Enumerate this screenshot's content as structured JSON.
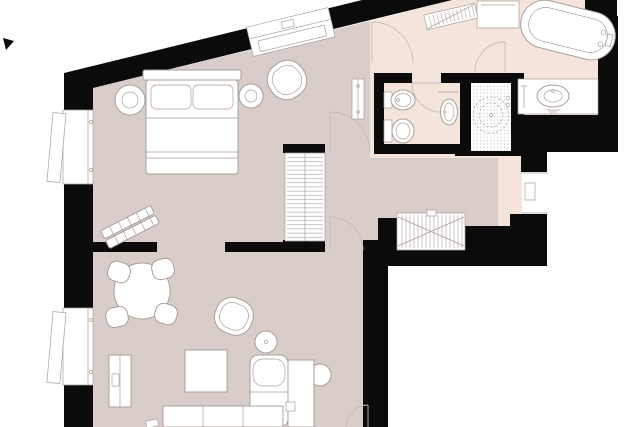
{
  "page": {
    "type": "architectural-floor-plan",
    "description": "Top-down 2D apartment floor plan, black walls, white line-drawn furniture, no text labels visible"
  },
  "colors": {
    "wall": "#0b0b0b",
    "floor_main": "#d9cdc9",
    "floor_bath": "#f5e4db",
    "furniture_fill": "#ffffff",
    "line": "#a9a09b",
    "detail_line": "#c6bcb6",
    "dots": "#b9b1ab",
    "background": "#ffffff"
  },
  "plan": {
    "rooms": [
      {
        "name": "bedroom",
        "floor": "floor_main",
        "contents": [
          "double bed with headboard and two pillows",
          "round nightstand with lamp (left)",
          "round side table (right)",
          "tub armchair in corner",
          "luggage bench at angle",
          "built-in wardrobe with hanging rail",
          "small wall radiator in corridor"
        ]
      },
      {
        "name": "living-room",
        "floor": "floor_main",
        "contents": [
          "round dining table",
          "four dining chairs",
          "sideboard on left wall",
          "lounge armchair",
          "round floor lamp",
          "square coffee table",
          "sofa with chaise and round armrest",
          "daybed cut off at bottom edge"
        ]
      },
      {
        "name": "hallway",
        "floor": "floor_main",
        "contents": [
          "hatched radiator niche in south wall"
        ]
      },
      {
        "name": "bathroom",
        "floor": "floor_bath",
        "contents": [
          "freestanding bathtub (rotated, top-right)",
          "vanity counter with oval basin (right)",
          "walk-in shower with dotted floor and round drain",
          "wall-hung washbasin",
          "hatched radiator on diagonal wall",
          "shelf block at top edge"
        ]
      },
      {
        "name": "wc",
        "floor": "floor_bath",
        "contents": [
          "toilet",
          "bidet"
        ]
      },
      {
        "name": "entry",
        "floor": "floor_bath",
        "contents": [
          "entrance door in right wall"
        ]
      }
    ],
    "windows": [
      {
        "id": "window-left-upper",
        "location": "left wall, bedroom, open casement"
      },
      {
        "id": "window-left-lower",
        "location": "left wall, living room, open casement"
      },
      {
        "id": "window-diagonal",
        "location": "slanted top wall, bedroom"
      }
    ],
    "doors": [
      "bedroom to bathroom vestibule (arc at diagonal wall)",
      "bedroom to corridor",
      "corridor to living room",
      "wc door",
      "bathing area door near tub",
      "apartment entrance door in right wall",
      "living room door at bottom edge (cut off)"
    ],
    "wall_features": [
      "thick black poché walls",
      "diagonal wall at top-left",
      "stepped outer wall top-right",
      "L-shaped outer corner bottom-right"
    ]
  }
}
